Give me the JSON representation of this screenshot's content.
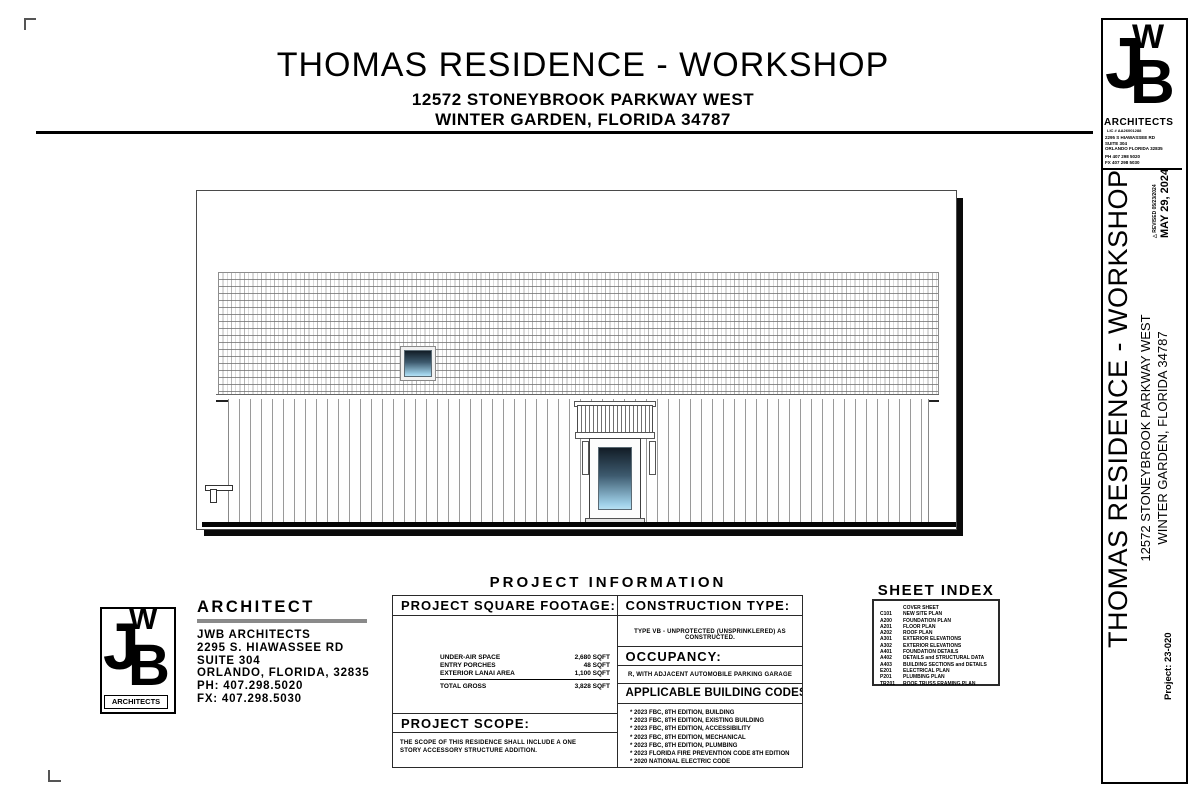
{
  "header": {
    "title": "THOMAS RESIDENCE - WORKSHOP",
    "address_line1": "12572 STONEYBROOK PARKWAY WEST",
    "address_line2": "WINTER GARDEN, FLORIDA 34787"
  },
  "drawing": {
    "name": "side exterior elevation",
    "colors": {
      "glass_top": "#121d27",
      "glass_bottom": "#a7d4ea",
      "ground_line": "#050505",
      "hatch_gray": "#8f8f8f"
    }
  },
  "project_information": {
    "title": "PROJECT INFORMATION",
    "square_footage": {
      "heading": "PROJECT SQUARE FOOTAGE:",
      "rows": [
        {
          "label": "UNDER-AIR SPACE",
          "value": "2,680 SQFT"
        },
        {
          "label": "ENTRY PORCHES",
          "value": "48 SQFT"
        },
        {
          "label": "EXTERIOR LANAI AREA",
          "value": "1,100 SQFT"
        }
      ],
      "total_label": "TOTAL GROSS",
      "total_value": "3,828 SQFT"
    },
    "scope": {
      "heading": "PROJECT SCOPE:",
      "text": "THE SCOPE OF THIS RESIDENCE SHALL INCLUDE A ONE STORY ACCESSORY STRUCTURE ADDITION."
    },
    "construction_type": {
      "heading": "CONSTRUCTION TYPE:",
      "text": "TYPE VB - UNPROTECTED (UNSPRINKLERED) AS CONSTRUCTED."
    },
    "occupancy": {
      "heading": "OCCUPANCY:",
      "text": "R, WITH ADJACENT AUTOMOBILE PARKING GARAGE"
    },
    "codes": {
      "heading": "APPLICABLE BUILDING CODES:",
      "bullet": "*",
      "items": [
        "2023 FBC, 8TH EDITION, BUILDING",
        "2023 FBC, 8TH EDITION, EXISTING BUILDING",
        "2023 FBC, 8TH EDITION, ACCESSIBILITY",
        "2023 FBC, 8TH EDITION, MECHANICAL",
        "2023 FBC, 8TH EDITION, PLUMBING",
        "2023 FLORIDA FIRE PREVENTION CODE 8TH EDITION",
        "2020 NATIONAL ELECTRIC CODE"
      ]
    }
  },
  "sheet_index": {
    "title": "SHEET INDEX",
    "rows": [
      {
        "code": "",
        "name": "COVER SHEET"
      },
      {
        "code": "C101",
        "name": "NEW SITE PLAN"
      },
      {
        "code": "A200",
        "name": "FOUNDATION PLAN"
      },
      {
        "code": "A201",
        "name": "FLOOR PLAN"
      },
      {
        "code": "A202",
        "name": "ROOF PLAN"
      },
      {
        "code": "A301",
        "name": "EXTERIOR ELEVATIONS"
      },
      {
        "code": "A302",
        "name": "EXTERIOR ELEVATIONS"
      },
      {
        "code": "A401",
        "name": "FOUNDATION DETAILS"
      },
      {
        "code": "A402",
        "name": "DETAILS and STRUCTURAL DATA"
      },
      {
        "code": "A403",
        "name": "BUILDING SECTIONS and DETAILS"
      },
      {
        "code": "E201",
        "name": "ELECTRICAL PLAN"
      },
      {
        "code": "P201",
        "name": "PLUMBING PLAN"
      },
      {
        "code": "TR201",
        "name": "ROOF TRUSS FRAMING PLAN"
      }
    ]
  },
  "architect_block": {
    "heading": "ARCHITECT",
    "firm": "JWB ARCHITECTS",
    "address1": "2295 S. HIAWASSEE RD",
    "address2": "SUITE 304",
    "address3": "ORLANDO, FLORIDA, 32835",
    "phone": "PH: 407.298.5020",
    "fax": "FX: 407.298.5030",
    "logo": {
      "j": "J",
      "w": "W",
      "b": "B",
      "label": "ARCHITECTS"
    }
  },
  "titleblock": {
    "logo": {
      "j": "J",
      "w": "W",
      "b": "B",
      "label": "ARCHITECTS",
      "license": "LIC # AA26001288"
    },
    "address1": "2295 S HIAWASSEE RD",
    "address2": "SUITE 304",
    "address3": "ORLANDO FLORIDA 32835",
    "phone": "PH 407 298 5020",
    "fax": "FX 407 298 5030",
    "revision_triangle_icon": "△",
    "revised": "REVISED  05/23/2024",
    "date": "MAY 29, 2024",
    "project_title": "THOMAS RESIDENCE - WORKSHOP",
    "project_address1": "12572 STONEYBROOK PARKWAY WEST",
    "project_address2": "WINTER GARDEN, FLORIDA 34787",
    "project_number": "Project: 23-020"
  }
}
